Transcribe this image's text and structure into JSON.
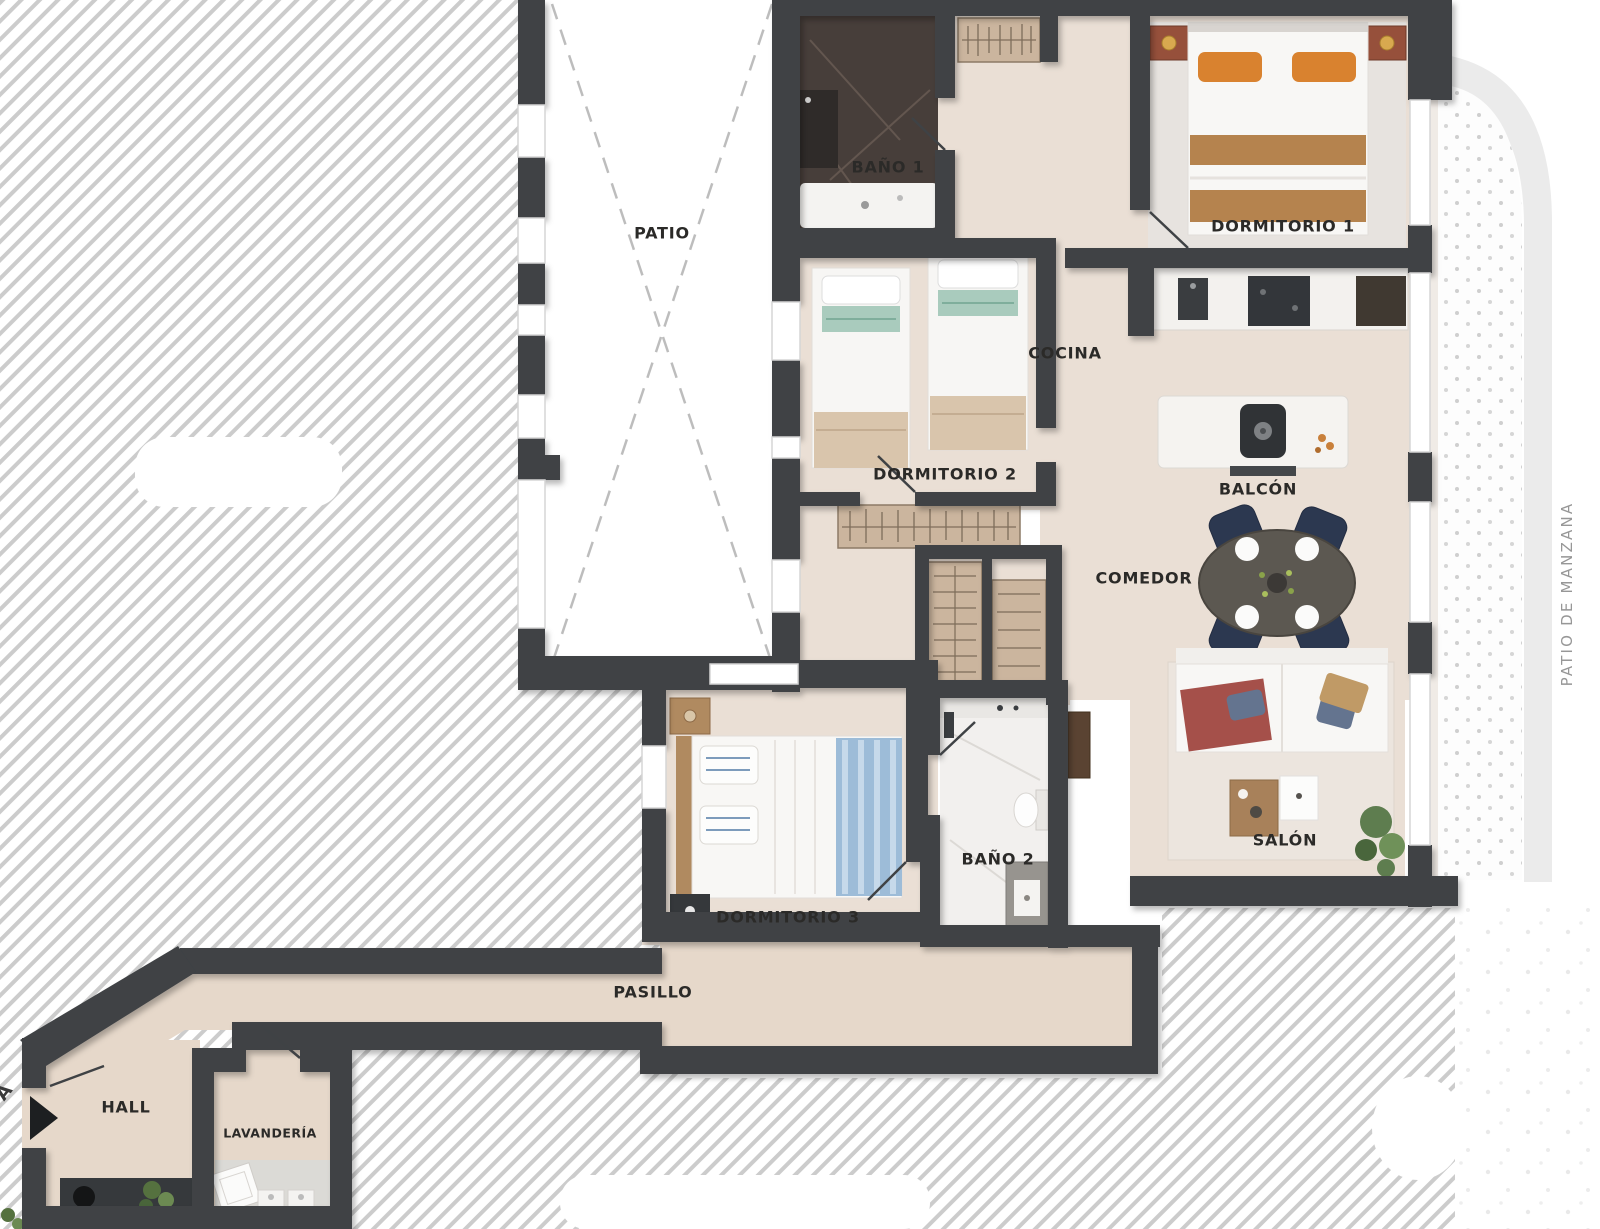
{
  "image": {
    "width": 1600,
    "height": 1229,
    "kind": "residential floor plan, top-down render"
  },
  "rooms": [
    {
      "id": "patio",
      "label": "PATIO"
    },
    {
      "id": "bano1",
      "label": "BAÑO 1"
    },
    {
      "id": "dormitorio1",
      "label": "DORMITORIO 1"
    },
    {
      "id": "cocina",
      "label": "COCINA"
    },
    {
      "id": "dormitorio2",
      "label": "DORMITORIO 2"
    },
    {
      "id": "balcon",
      "label": "BALCÓN"
    },
    {
      "id": "comedor",
      "label": "COMEDOR"
    },
    {
      "id": "salon",
      "label": "SALÓN"
    },
    {
      "id": "bano2",
      "label": "BAÑO 2"
    },
    {
      "id": "dormitorio3",
      "label": "DORMITORIO 3"
    },
    {
      "id": "pasillo",
      "label": "PASILLO"
    },
    {
      "id": "hall",
      "label": "HALL"
    },
    {
      "id": "lavanderia",
      "label": "LAVANDERÍA"
    },
    {
      "id": "patio-de-manzana",
      "label": "PATIO DE MANZANA"
    }
  ],
  "annotations": {
    "edge_fragment": "A"
  },
  "colors": {
    "wall": "#3f4245",
    "floor": "#eadfd5",
    "floor_corridor": "#e6d8ca",
    "bath1_floor": "#473e3a",
    "bath2_floor": "#f2f0ee",
    "hatch_line": "#cccccc",
    "terrace_dots": "#cfcfcf",
    "accent_orange": "#d9822f",
    "accent_tan": "#b5834e",
    "accent_teal": "#a9cbbd",
    "accent_blue": "#9dbcd8",
    "accent_navy": "#2c3850",
    "accent_red": "#a5504a",
    "label_text": "#2b2a28",
    "outside_label_text": "#979797"
  }
}
